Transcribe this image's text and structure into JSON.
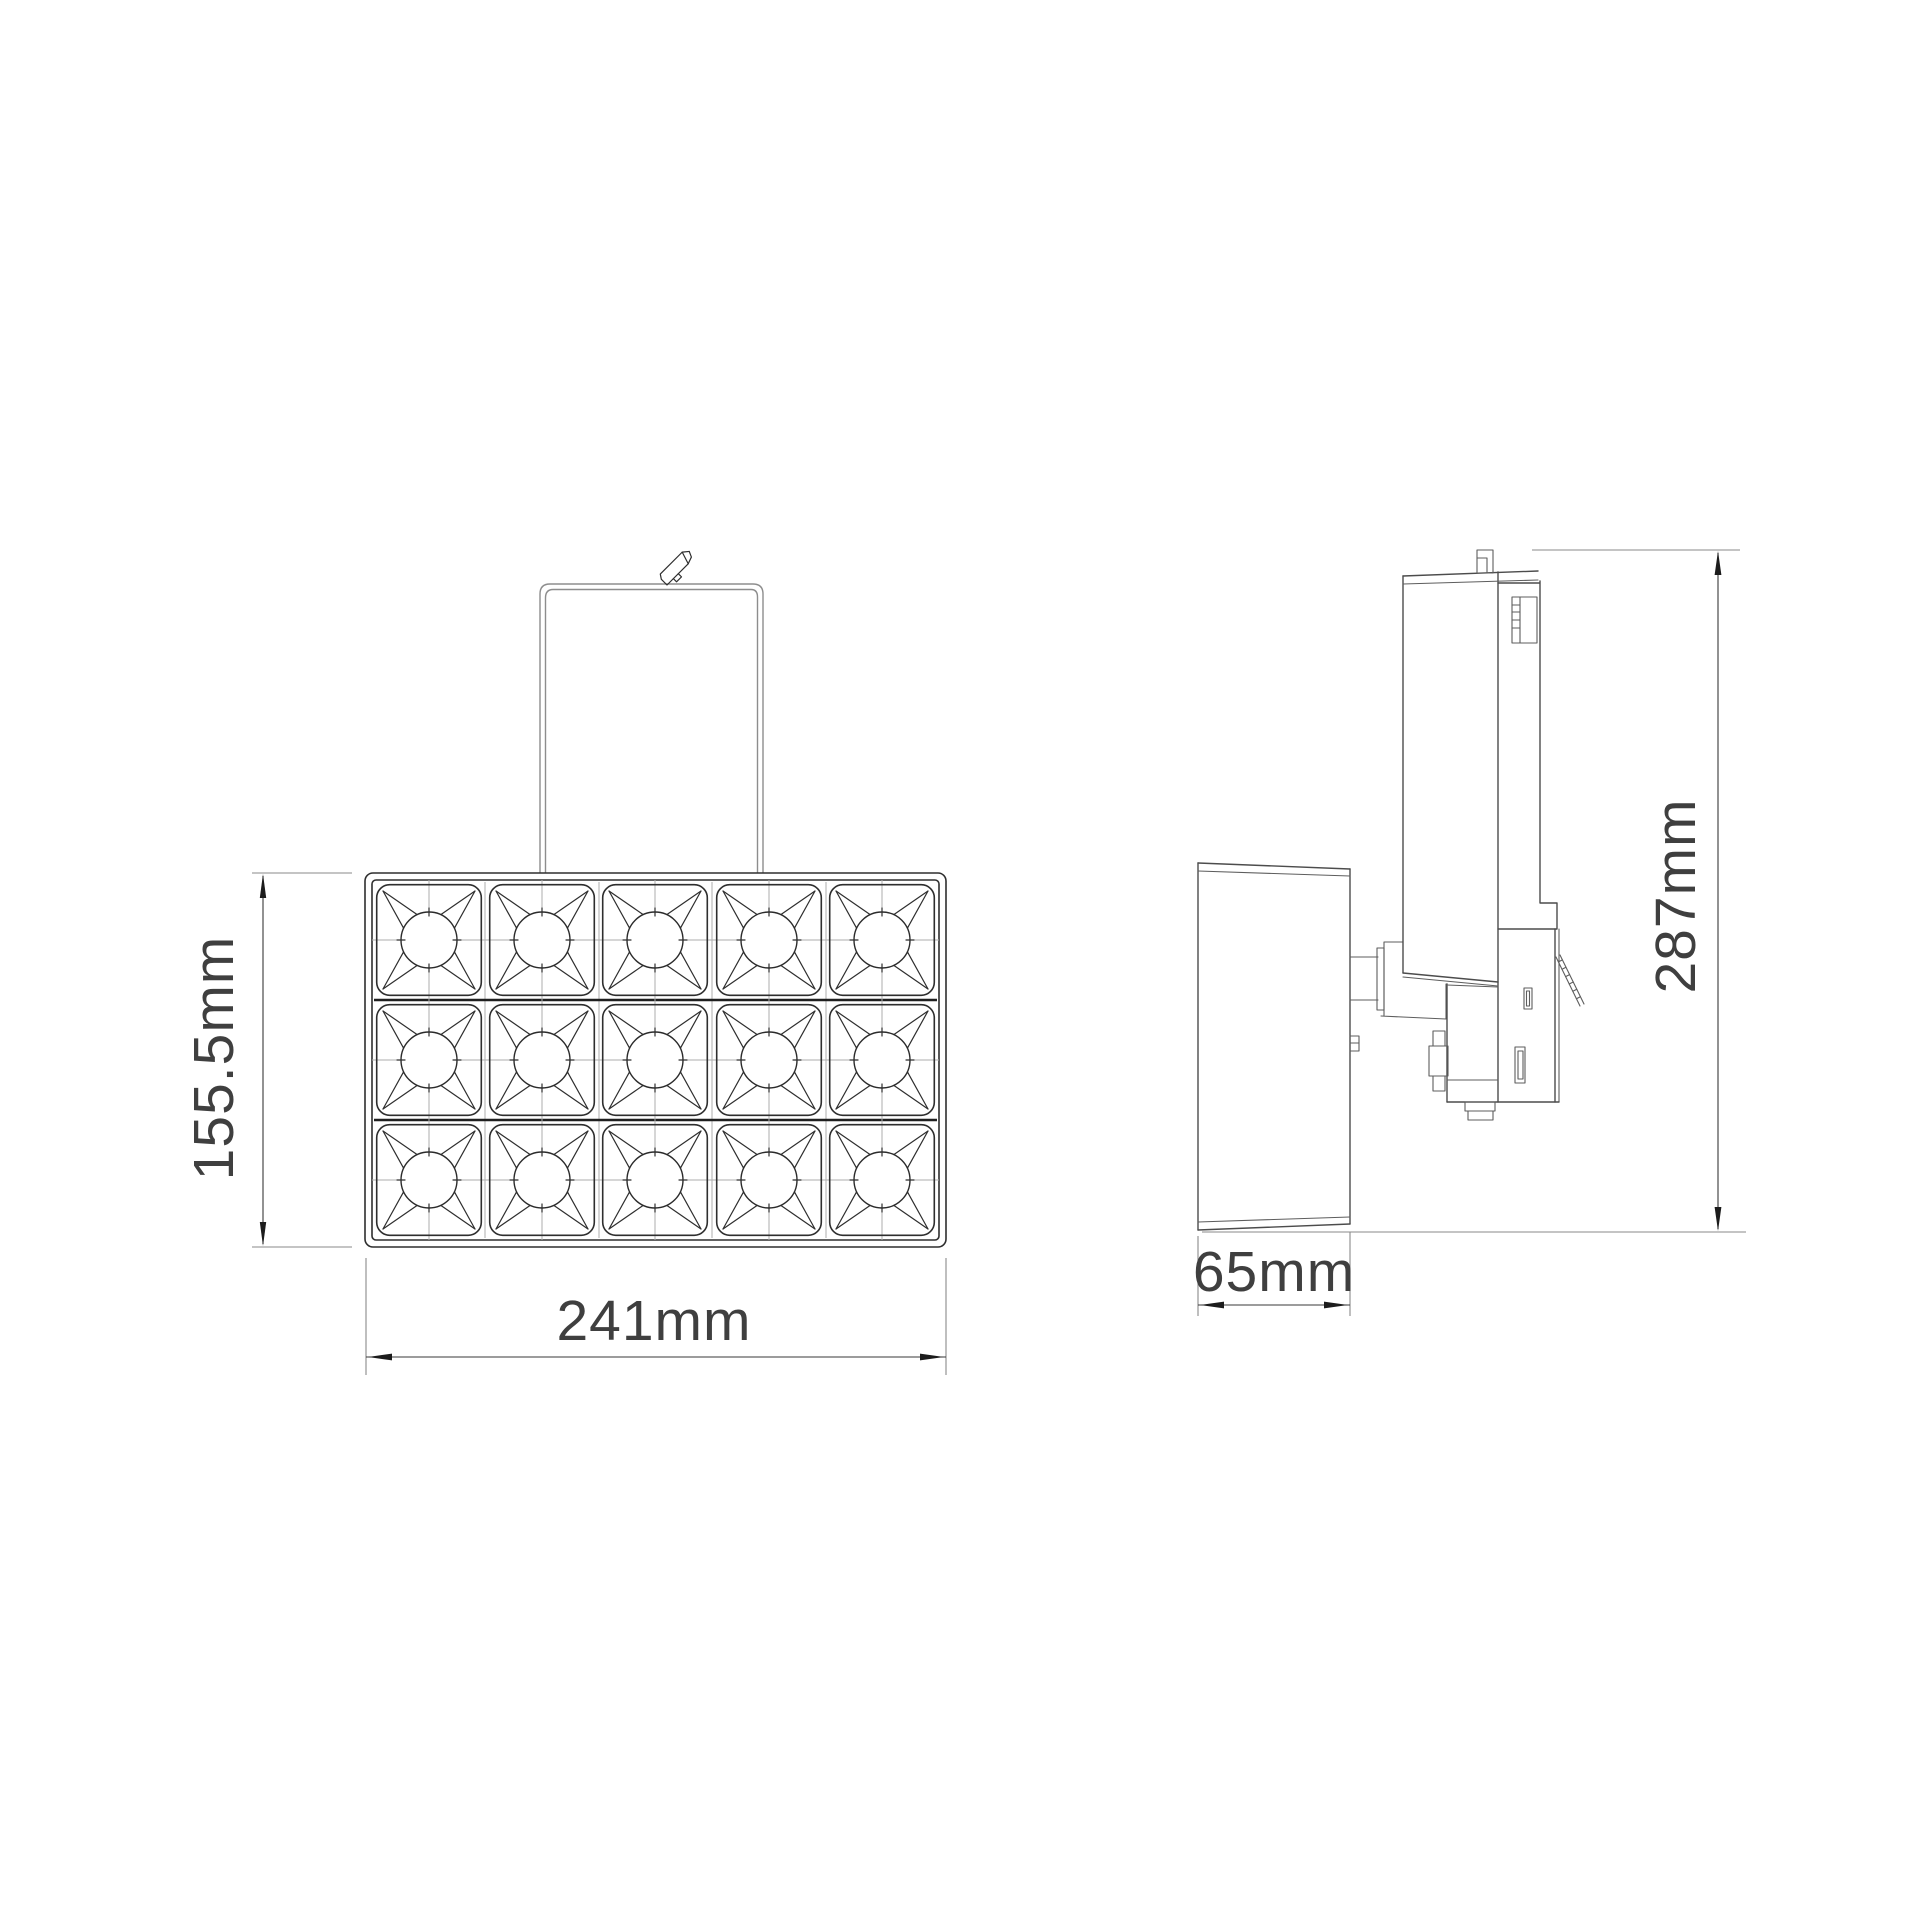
{
  "front_view": {
    "height_dimension": "155.5mm",
    "width_dimension": "241mm",
    "led_grid": {
      "columns": 5,
      "rows": 3
    }
  },
  "side_view": {
    "depth_dimension": "65mm",
    "height_dimension": "287mm"
  },
  "style": {
    "background": "#ffffff",
    "outline_color": "#2e2e2e",
    "secondary_line_color": "#8d8d8d",
    "dimension_line_color": "#3a3a3a",
    "dimension_text_color": "#3f3f3f"
  }
}
